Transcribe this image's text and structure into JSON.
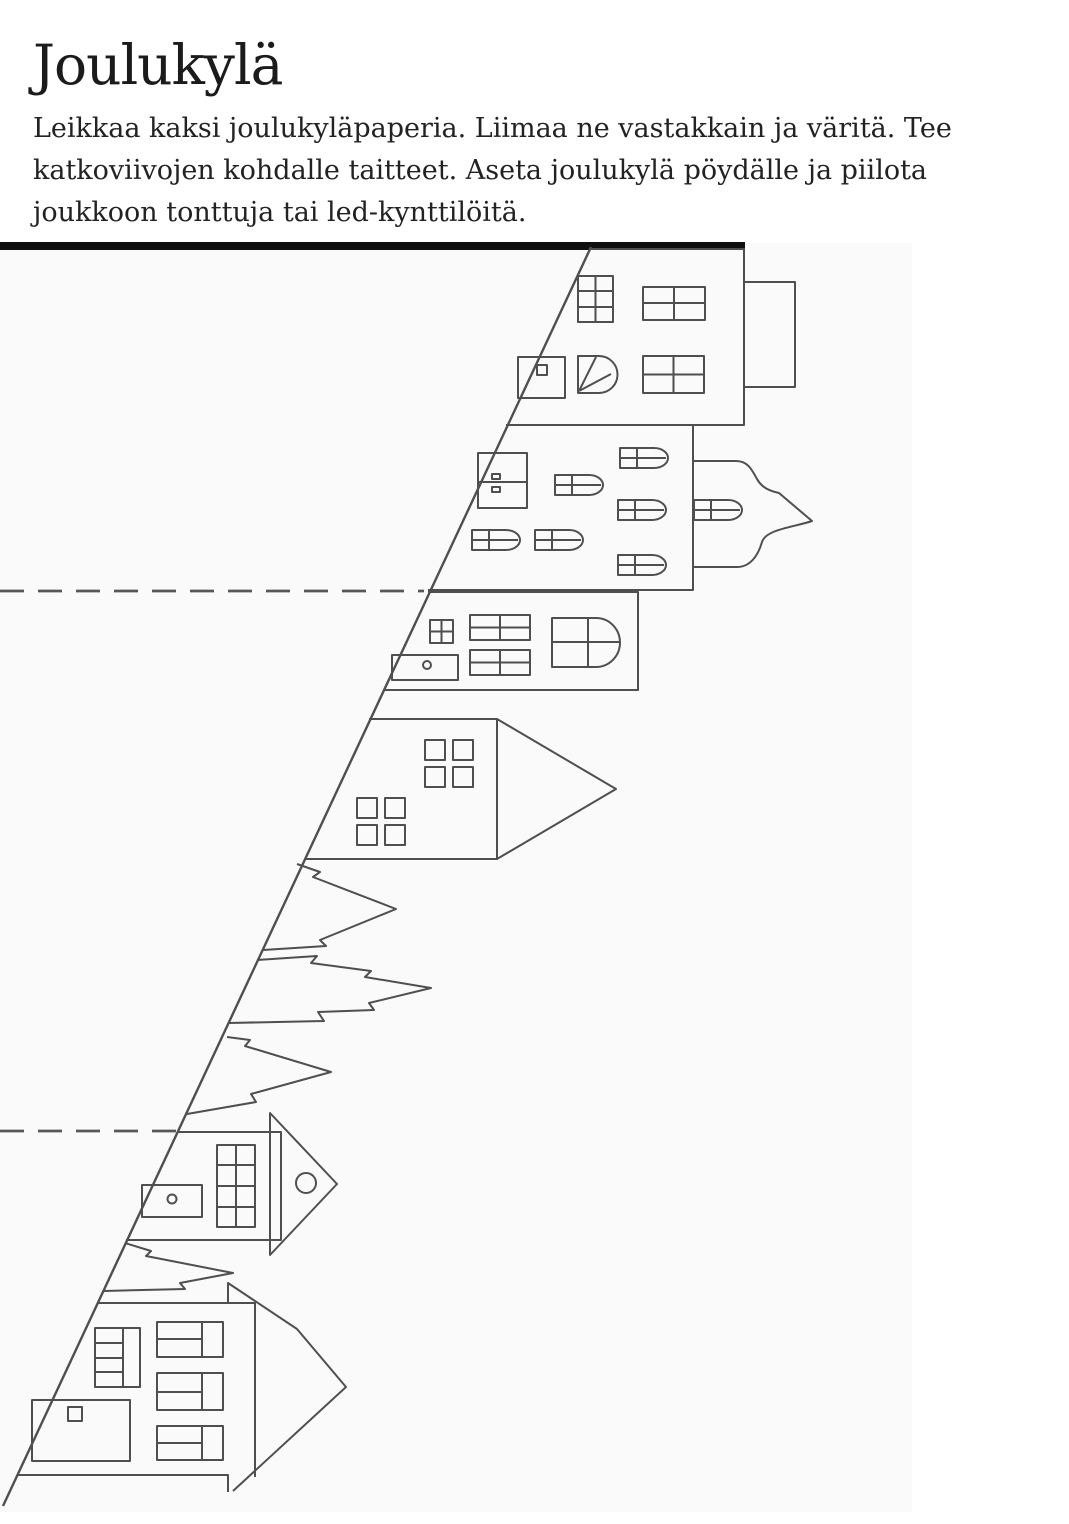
{
  "page": {
    "title": "Joulukylä",
    "instructions_lines": [
      "Leikkaa kaksi joulukyläpaperia. Liimaa ne vastakkain ja väritä. Tee",
      "katkoviivojen kohdalle taitteet. Aseta joulukylä pöydälle ja piilota",
      "joukkoon tonttuja tai led-kynttilöitä."
    ]
  },
  "figure": {
    "description": "Paper craft cut-out template: a diagonal cutting line with six outlined houses, four sideways fir trees and two dashed fold lines",
    "colors": {
      "line": "#4f4f4f",
      "dash": "#585858",
      "bar": "#0f0f0f",
      "background": "#fafafa"
    }
  }
}
